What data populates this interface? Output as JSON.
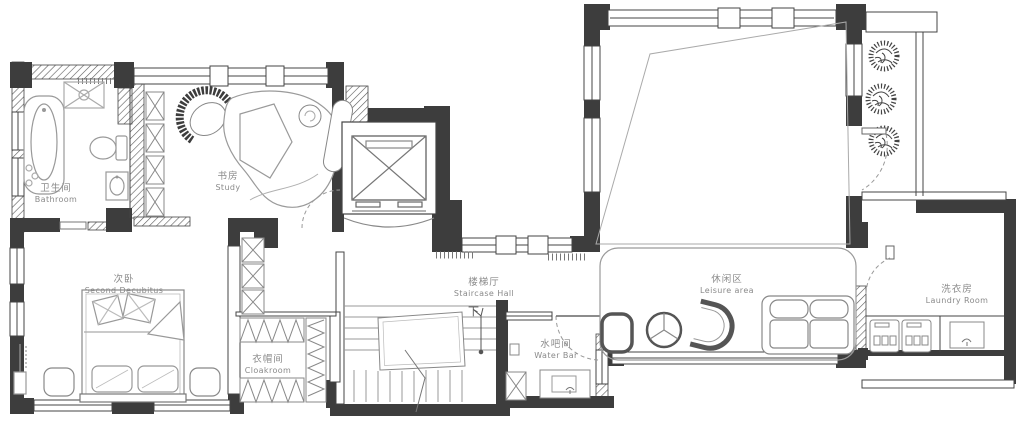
{
  "plan": {
    "type": "floor-plan",
    "colors": {
      "background": "#ffffff",
      "wall": "#3d3d3d",
      "wall_outline": "#4a4a4a",
      "furniture_line": "#9a9a9a",
      "light_line": "#b0b0b0",
      "label_text": "#8a8a8a"
    },
    "rooms": {
      "bathroom": {
        "zh": "卫生间",
        "en": "Bathroom"
      },
      "study": {
        "zh": "书房",
        "en": "Study"
      },
      "second_bedroom": {
        "zh": "次卧",
        "en": "Second Decubitus"
      },
      "cloakroom": {
        "zh": "衣帽间",
        "en": "Cloakroom"
      },
      "staircase_hall": {
        "zh": "楼梯厅",
        "en": "Staircase Hall"
      },
      "water_bar": {
        "zh": "水吧间",
        "en": "Water Bar"
      },
      "leisure_area": {
        "zh": "休闲区",
        "en": "Leisure area"
      },
      "laundry_room": {
        "zh": "洗衣房",
        "en": "Laundry Room"
      }
    },
    "annotations": {
      "stairs_down": "下"
    },
    "icons": {
      "bathtub-icon": "rounded rectangle with inner oval",
      "toilet-icon": "oval bowl with tank",
      "shower-icon": "x-crossed square with drain circle",
      "basin-icon": "small rect with oval",
      "wardrobe-x-icon": "stacked x-boxes",
      "hanger-rail-icon": "zigzag strip",
      "bed-icon": "bed with pillows and duvet fold",
      "nightstand-icon": "rounded square",
      "floor-lamp-icon": "small rect with stem",
      "elevator-icon": "rectangle with cross",
      "stairs-icon": "parallel treads with break line",
      "down-arrow-icon": "arrow with stem and dot",
      "door-swing-icon": "dashed quarter arc",
      "armchair-icon": "crescent back chair",
      "round-table-icon": "circle with Y spokes",
      "u-chair-icon": "U shaped lounge chair",
      "sofa-icon": "two-cushion sofa",
      "plant-icon": "spiky circle shrub",
      "washer-icon": "square appliance front",
      "sink-icon": "rect with faucet",
      "void-line-icon": "large trapezoid outline",
      "window-icon": "double-line band in wall"
    }
  }
}
